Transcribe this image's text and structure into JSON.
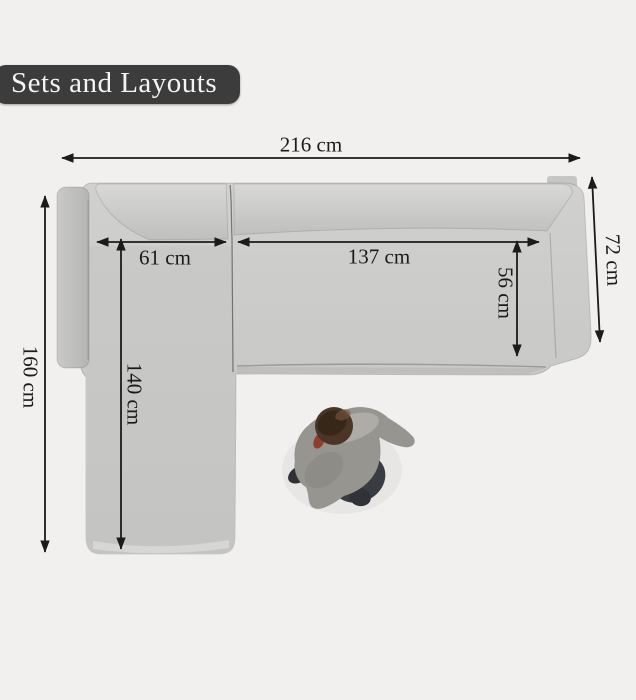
{
  "banner": {
    "label": "Sets and Layouts",
    "bg_color": "#3c3c3c",
    "text_color": "#f4f4f4"
  },
  "diagram": {
    "description": "Top view of an L-shaped sectional sofa with dimension arrows and a walking person shown for scale",
    "unit": "cm",
    "background_color": "#f1f0ee",
    "sofa_color": "#c6c6c4",
    "arrow_color": "#1b1b1b",
    "figure": "person-top-view",
    "dimensions": {
      "overall_width": {
        "label": "216 cm",
        "value": 216
      },
      "left_depth": {
        "label": "160 cm",
        "value": 160
      },
      "right_depth": {
        "label": "72 cm",
        "value": 72
      },
      "left_seat_width": {
        "label": "61 cm",
        "value": 61
      },
      "right_seat_width": {
        "label": "137 cm",
        "value": 137
      },
      "seat_depth": {
        "label": "56 cm",
        "value": 56
      },
      "chaise_length": {
        "label": "140 cm",
        "value": 140
      }
    }
  }
}
